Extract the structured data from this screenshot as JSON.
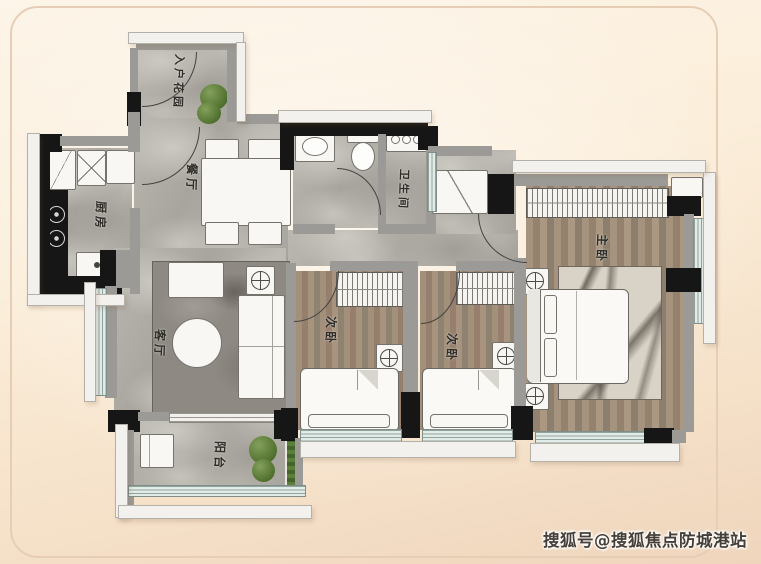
{
  "plan": {
    "rooms": [
      {
        "id": "entry-garden",
        "label": "入户花园"
      },
      {
        "id": "kitchen",
        "label": "厨房"
      },
      {
        "id": "dining",
        "label": "餐厅"
      },
      {
        "id": "bathroom",
        "label": "卫生间"
      },
      {
        "id": "living",
        "label": "客厅"
      },
      {
        "id": "balcony",
        "label": "阳台"
      },
      {
        "id": "bedroom-2",
        "label": "次卧"
      },
      {
        "id": "bedroom-3",
        "label": "次卧"
      },
      {
        "id": "master-bedroom",
        "label": "主卧"
      }
    ]
  },
  "watermark": {
    "text": "搜狐号@搜狐焦点防城港站"
  },
  "colors": {
    "background": "#f8e8d5",
    "wall_dark": "#161616",
    "wall_gray": "#9b9a96",
    "floor_marble": "#b5b1ab",
    "floor_wood": "#9a8872",
    "window": "#e3ebe8",
    "plant": "#52722f",
    "frame": "#e7cdb6"
  }
}
